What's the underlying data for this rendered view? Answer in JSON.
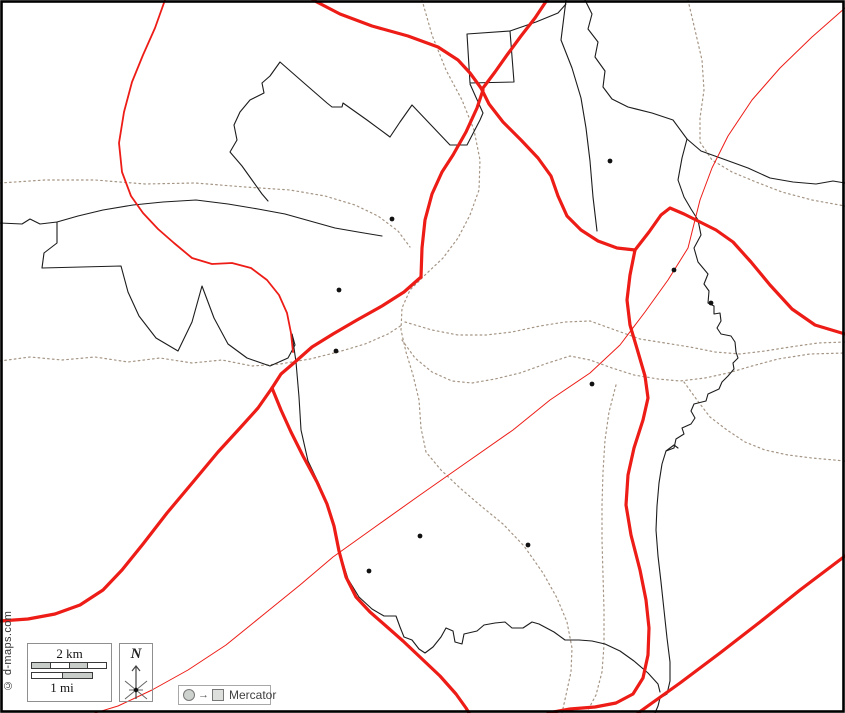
{
  "attribution": {
    "text": "© d-maps.com"
  },
  "scalebar": {
    "km_label": "2 km",
    "mi_label": "1 mi",
    "km_pattern": [
      "gray",
      "white",
      "gray",
      "white"
    ],
    "mi_pattern": [
      "white",
      "gray"
    ],
    "segment_gray": "#c9cdc9",
    "segment_white": "#ffffff"
  },
  "compass": {
    "label": "N"
  },
  "projection": {
    "arrow": "→",
    "label": "Mercator"
  },
  "colors": {
    "frame": "#000000",
    "road_red": "#ed1c16",
    "boundary_black": "#1c1c1c",
    "boundary_dotted": "#a59585",
    "settlement": "#111111",
    "background": "#ffffff"
  },
  "map": {
    "width": 845,
    "height": 713,
    "settlement_radius": 2.4,
    "settlements": [
      {
        "x": 392,
        "y": 219
      },
      {
        "x": 610,
        "y": 161
      },
      {
        "x": 339,
        "y": 290
      },
      {
        "x": 336,
        "y": 351
      },
      {
        "x": 674,
        "y": 270
      },
      {
        "x": 711,
        "y": 303
      },
      {
        "x": 592,
        "y": 384
      },
      {
        "x": 420,
        "y": 536
      },
      {
        "x": 369,
        "y": 571
      },
      {
        "x": 528,
        "y": 545
      }
    ],
    "layers": [
      {
        "name": "boundary-dotted",
        "color": "#a59585",
        "width": 1.2,
        "dash": "1.6,3.2",
        "paths": [
          "M0,183 L45,180 L95,180 L145,184 L195,183 L245,187 L290,190 L325,196 L355,205 L378,216 L398,231 L410,247",
          "M422,0 L432,35 L446,70 L462,100 L474,130 L480,160 L479,190 L470,215 L458,238 L443,258 L425,275 L410,290 L402,308 L401,330 L406,352 L413,375 L419,400 L421,428 L426,452 L441,470 L460,488 L481,506 L503,524 L524,546 L543,573 L557,598 L567,622 L572,648 L571,672 L566,695 L562,713",
          "M405,322 L432,330 L458,335 L486,335 L512,332 L540,326 L565,322 L590,321 L615,330 L640,339 L665,343 L690,347 L715,352 L740,354 L765,351 L790,347 L818,343 L845,342",
          "M0,361 L30,357 L62,360 L95,357 L128,362 L160,358 L192,363 L222,360 L252,366 L280,364 L310,359 L338,352 L365,344 L388,334 L402,325",
          "M402,340 L415,358 L432,372 L452,381 L472,383 L495,379 L520,373 L548,363 L570,356 L590,360 L612,368 L634,375 L658,379 L680,381 L705,378 L728,373 L752,366 L778,359 L810,354 L845,353",
          "M616,385 L609,412 L605,440 L603,472 L602,505 L602,540 L603,575 L604,610 L604,645 L602,672 L596,695 L588,710",
          "M684,382 L697,400 L710,417 L727,430 L745,442 L765,450 L788,455 L812,458 L845,461",
          "M688,0 L695,30 L702,60 L704,90 L700,118 L700,142 L712,160 L732,172 L756,182 L782,192 L812,200 L845,206"
        ]
      },
      {
        "name": "boundary-black",
        "color": "#1c1c1c",
        "width": 1.1,
        "dash": null,
        "paths": [
          "M0,223 L22,224 L30,219 L40,224 L57,222 L78,216 L103,210 L133,205 L163,202 L196,200 L228,204 L258,209 L285,214 L310,221 L335,228 L358,232 L382,236",
          "M57,222 L57,243 L44,253 L42,268",
          "M42,268 L121,266 L128,292 L139,316 L156,338 L178,351 L192,322 L202,286 L214,318 L228,344 L247,358 L270,366 L288,358 L295,345 L292,334",
          "M292,334 L296,362 L299,397 L301,430 L308,461 L319,484 L328,506 L335,528 L340,553 L348,579 L359,597 L372,609 L384,616 L396,616 L400,627 L404,637 L412,640 L419,649 L425,653 L433,647 L441,637 L446,628 L453,631 L455,642 L462,644 L464,634 L477,631 L484,625 L495,623 L505,622 L512,628 L523,628 L532,622 L539,624 L554,632 L565,640 L579,640 L592,641 L605,644 L620,651 L634,661 L648,673 L658,684 L660,692",
          "M687,139 L682,158 L678,180 L684,197 L691,209 L698,220 L701,235 L694,248 L698,262 L708,274 L704,284 L709,291 L708,303 L714,306 L714,314 L720,313 L721,321 L717,328 L721,334 L731,336 L735,342 L736,352 L738,358 L733,363 L734,369 L728,376 L722,382 L719,389 L708,394 L706,401 L694,404 L691,411 L695,418 L691,424 L682,428 L684,434 L676,439 L674,448 L666,451 L662,464 L659,483 L657,506 L656,530 L658,556 L661,582 L664,610 L667,638 L670,662 L670,681 L667,694 L660,698 L658,706 L655,713",
          "M666,451 L674,445 L678,448",
          "M585,0 L592,14 L588,29 L598,42 L595,57 L605,71 L603,87 L612,99 L628,107 L652,113 L673,120 L687,139 L701,151 L726,160 L748,168 L770,178 L793,182 L816,184 L833,181 L845,183",
          "M566,0 L561,40 L572,68 L581,98 L586,128 L590,161 L593,197 L597,231",
          "M470,83 L467,34 L510,31 L514,82 Z",
          "M510,31 L536,22 L558,13 L566,4",
          "M268,201 L262,194 L252,180 L242,166 L230,152 L237,140 L234,125 L240,112 L250,100 L264,93 L262,83 L270,76 L280,62 L304,83 L327,103 L332,107 L342,107 L343,103 L367,120 L390,137 L400,122 L412,105 L431,125 L450,145 L467,145 L480,120 L483,113 L470,84"
        ]
      },
      {
        "name": "road-thin",
        "color": "#ed1c16",
        "width": 1,
        "dash": null,
        "paths": [
          "M845,8 L812,37 L780,68 L752,100 L728,136 L712,168 L700,200 L688,248 L668,280 L645,312 L620,345 L590,373 L550,400 L513,430 L460,467 L420,495 L375,527 L333,557 L300,585 L263,615 L226,645 L188,670 L152,690 L118,706 L95,713"
        ]
      },
      {
        "name": "road-medium",
        "color": "#ed1c16",
        "width": 1.8,
        "dash": null,
        "paths": [
          "M165,0 L155,28 L143,55 L132,82 L124,112 L119,143 L122,172 L131,196 L143,213 L158,229 L174,243 L192,258 L212,264 L232,263 L251,268 L267,280 L279,295 L287,313 L291,333 L293,352"
        ]
      },
      {
        "name": "road-major",
        "color": "#ed1c16",
        "width": 3.2,
        "dash": null,
        "paths": [
          "M313,0 L340,14 L372,26 L408,36 L438,47 L458,60 L470,73 L481,88",
          "M547,0 L535,18 L521,36 L507,55 L495,72 L483,88",
          "M481,88 L489,104 L503,122 L521,140 L538,158 L551,176 L558,196 L567,216 L581,230 L598,241 L617,248 L635,250",
          "M483,90 L477,108 L466,132 L453,155 L442,172 L432,194 L425,220 L422,248 L421,277",
          "M635,250 L649,232 L661,215 L670,208 L684,214 L700,222 L716,230 L733,242 L751,262 L770,285 L792,309 L815,325 L845,334",
          "M635,250 L630,275 L627,300 L630,325 L638,352 L645,376 L648,398 L643,420 L634,448 L628,475 L626,505 L631,535 L640,570 L646,600 L649,628 L648,655 L643,678 L633,694 L616,703 L595,707 L570,709 L548,713",
          "M638,713 L680,683 L720,653 L760,622 L800,590 L845,556",
          "M421,277 L404,292 L382,306 L357,320 L333,334 L312,347 L295,362 L281,374 L272,388",
          "M272,388 L258,408 L240,428 L218,452 L193,482 L167,513 L143,544 L122,570 L103,590 L80,605 L55,614 L28,619 L0,621",
          "M272,388 L281,410 L291,432 L303,456 L317,482 L327,504 L334,526 L339,551 L346,577 L356,597 L370,612 L386,626 L403,641 L421,658 L440,676 L456,694 L466,708 L469,713"
        ]
      }
    ]
  }
}
